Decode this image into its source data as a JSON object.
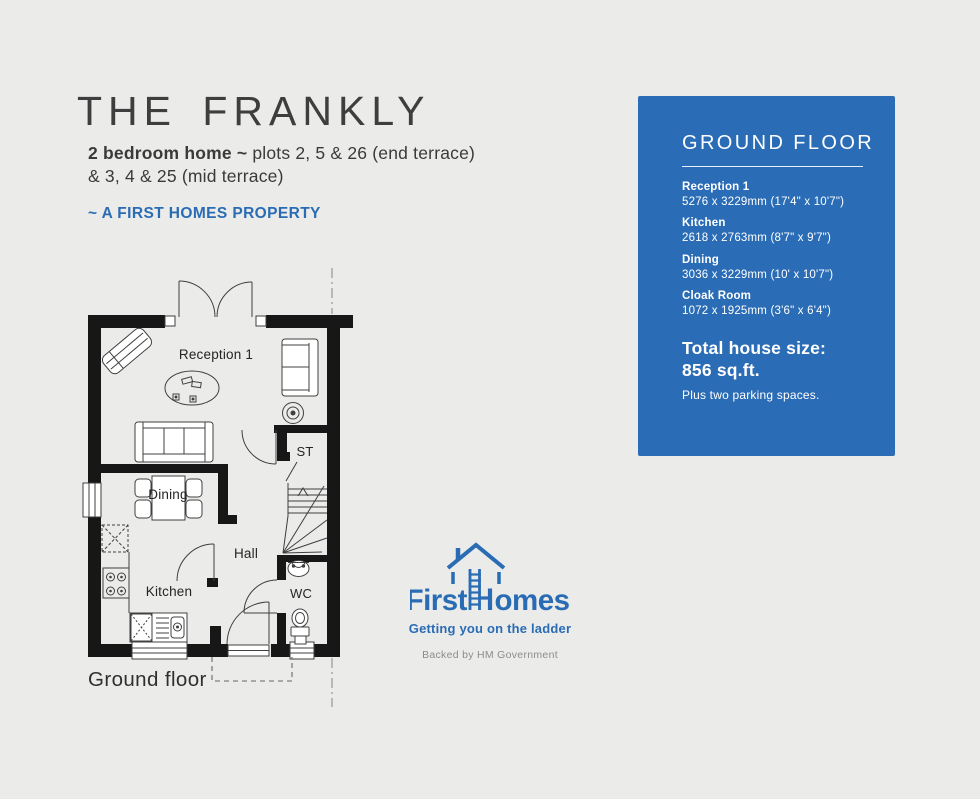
{
  "header": {
    "title": "THE FRANKLY",
    "subtitle_bold": "2 bedroom home ~",
    "subtitle_rest": " plots 2, 5 & 26 (end terrace)",
    "subtitle_line2": "& 3, 4 & 25 (mid terrace)",
    "property_tag": "~ A FIRST HOMES  PROPERTY"
  },
  "panel": {
    "heading": "GROUND FLOOR",
    "accent_color": "#2a6cb5",
    "rooms": [
      {
        "name": "Reception 1",
        "dims": "5276 x 3229mm (17'4\" x 10'7\")"
      },
      {
        "name": "Kitchen",
        "dims": "2618 x 2763mm (8'7\" x 9'7\")"
      },
      {
        "name": "Dining",
        "dims": "3036 x 3229mm (10' x 10'7\")"
      },
      {
        "name": "Cloak Room",
        "dims": "1072 x 1925mm (3'6\" x 6'4\")"
      }
    ],
    "total_label": "Total house size:",
    "total_value": "856 sq.ft.",
    "parking_note": "Plus two parking spaces."
  },
  "plan": {
    "labels": {
      "reception": "Reception 1",
      "st": "ST",
      "dining": "Dining",
      "hall": "Hall",
      "kitchen": "Kitchen",
      "wc": "WC"
    },
    "caption": "Ground floor"
  },
  "logo": {
    "word_first": "First",
    "word_homes_rest": "omes",
    "tagline": "Getting you on the ladder",
    "backed": "Backed by HM Government",
    "brand_color": "#2a6cb4"
  }
}
